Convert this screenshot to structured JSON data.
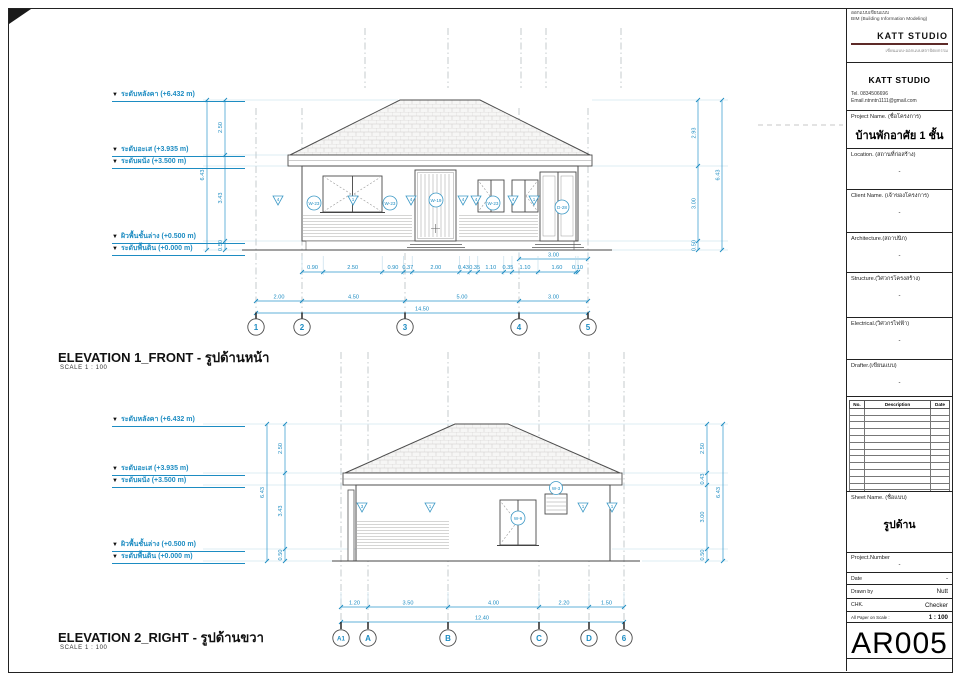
{
  "colors": {
    "accent": "#1d8cc2",
    "line": "#4d4d4d",
    "brand_rule": "#5d2a28"
  },
  "header": {
    "small_line1": "ออกแบบเขียนแบบ",
    "small_line2": "BIM (Building Information Modeling)",
    "brand": "KATT STUDIO",
    "tagline": "เขียนแบบ-ออกแบบสถาปัตยกรรม",
    "company": "KATT STUDIO",
    "tel": "Tel. 0834506696",
    "email": "Email.ntnntn1111@gmail.com"
  },
  "titleblock": {
    "project_label": "Project Name. (ชื่อโครงการ)",
    "project_value": "บ้านพักอาศัย 1 ชั้น",
    "location_label": "Location. (สถานที่ก่อสร้าง)",
    "location_value": "-",
    "client_label": "Client Name. (เจ้าของโครงการ)",
    "client_value": "-",
    "architecture_label": "Architecture.(สถาปนิก)",
    "architecture_value": "-",
    "structure_label": "Structure.(วิศวกรโครงสร้าง)",
    "structure_value": "-",
    "electrical_label": "Electrical.(วิศวกรไฟฟ้า)",
    "electrical_value": "-",
    "drafter_label": "Drafter.(เขียนแบบ)",
    "drafter_value": "-",
    "rev_headers": [
      "No.",
      "Description",
      "Date"
    ],
    "sheet_name_label": "Sheet Name. (ชื่อแบบ)",
    "sheet_name_value": "รูปด้าน",
    "project_number_label": "Project.Number",
    "project_number_value": "-",
    "date_label": "Date",
    "date_value": "-",
    "drawn_by_label": "Drawn by",
    "drawn_by_value": "Nutt",
    "chk_label": "CHK.",
    "chk_value": "Checker",
    "scale_label": "All Paper on Scale :",
    "scale_value": "1 : 100",
    "sheet_number": "AR005"
  },
  "levels": [
    "ระดับหลังคา (+6.432 m)",
    "ระดับอะเส (+3.935 m)",
    "ระดับผนัง (+3.500 m)",
    "ผิวพื้นชั้นล่าง (+0.500 m)",
    "ระดับพื้นดิน (+0.000 m)"
  ],
  "elevation1": {
    "title": "ELEVATION 1_FRONT - รูปด้านหน้า",
    "scale_note": "SCALE   1 : 100",
    "detail_dims": [
      "0.90",
      "2.50",
      "0.90",
      "0.37",
      "2.00",
      "0.43",
      "0.35",
      "1.10",
      "0.35",
      "1.10",
      "1.60",
      "0.10"
    ],
    "upper_dim": "3.00",
    "grid_dims": [
      "2.00",
      "4.50",
      "5.00",
      "3.00"
    ],
    "total_dim": "14.50",
    "grid_bubbles": [
      "1",
      "2",
      "3",
      "4",
      "5"
    ],
    "left_dims": [
      "2.50",
      "3.43",
      "0.50"
    ],
    "left_total": "6.43",
    "right_dims": [
      "2.93",
      "3.00",
      "0.50"
    ],
    "right_total": "6.43",
    "tags": [
      {
        "label": "4",
        "shape": "flag"
      },
      {
        "label": "W-23",
        "shape": "circle"
      },
      {
        "label": "1",
        "shape": "flag"
      },
      {
        "label": "W-23",
        "shape": "circle"
      },
      {
        "label": "4",
        "shape": "flag"
      },
      {
        "label": "W-19",
        "shape": "circle"
      },
      {
        "label": "4",
        "shape": "flag"
      },
      {
        "label": "4",
        "shape": "flag"
      },
      {
        "label": "W-23",
        "shape": "circle"
      },
      {
        "label": "4",
        "shape": "flag"
      },
      {
        "label": "1",
        "shape": "flag"
      },
      {
        "label": "D-28",
        "shape": "circle"
      }
    ]
  },
  "elevation2": {
    "title": "ELEVATION 2_RIGHT - รูปด้านขวา",
    "scale_note": "SCALE   1 : 100",
    "grid_dims": [
      "1.20",
      "3.50",
      "4.00",
      "2.20",
      "1.50"
    ],
    "total_dim": "12.40",
    "grid_bubbles": [
      "A1",
      "A",
      "B",
      "C",
      "D",
      "6"
    ],
    "left_dims": [
      "2.50",
      "3.43",
      "0.50"
    ],
    "left_total": "6.43",
    "right_dims": [
      "2.50",
      "0.43",
      "3.00",
      "0.50"
    ],
    "right_total": "6.43",
    "tags": [
      {
        "label": "3",
        "shape": "flag"
      },
      {
        "label": "1",
        "shape": "flag"
      },
      {
        "label": "W-9",
        "shape": "circle"
      },
      {
        "label": "1",
        "shape": "flag"
      },
      {
        "label": "1",
        "shape": "flag"
      }
    ],
    "vent_tag": "W-3"
  }
}
